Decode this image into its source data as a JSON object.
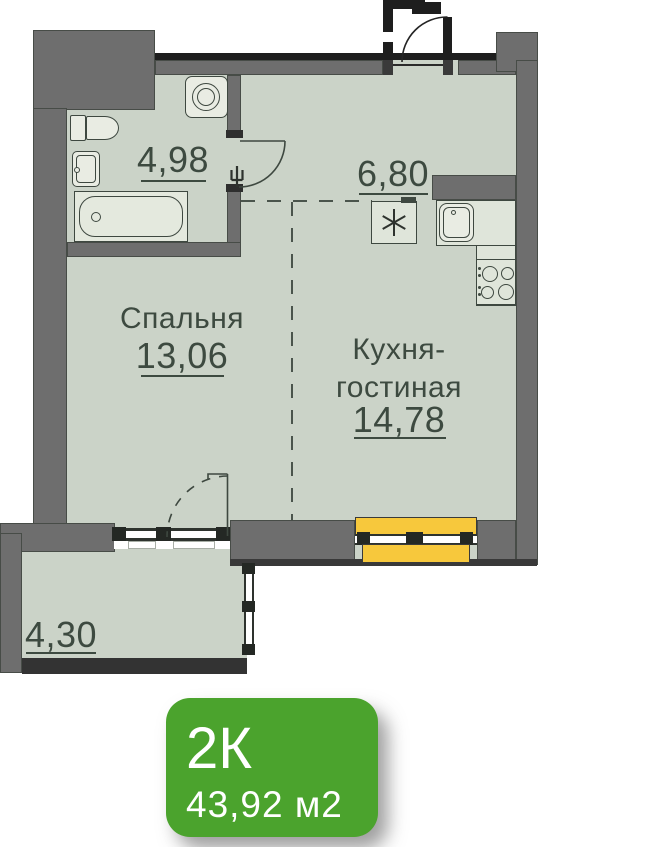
{
  "rooms": {
    "bathroom": {
      "area": "4,98"
    },
    "hallway": {
      "area": "6,80"
    },
    "bedroom": {
      "name": "Спальня",
      "area": "13,06"
    },
    "kitchen_living": {
      "name_line1": "Кухня-",
      "name_line2": "гостиная",
      "area": "14,78"
    },
    "balcony": {
      "area": "4,30"
    }
  },
  "badge": {
    "rooms": "2К",
    "area": "43,92 м2"
  },
  "colors": {
    "wall": "#6e6e6e",
    "floor": "#cbd3c8",
    "window_highlight": "#f7c83c",
    "badge_green": "#4ba32d",
    "text": "#3d4a40"
  },
  "fixtures": [
    "toilet-icon",
    "sink-icon",
    "bathtub-icon",
    "washing-machine-icon",
    "kitchen-sink-icon",
    "stove-icon",
    "vent-asterisk-icon",
    "door-swing-icon",
    "window-icon"
  ]
}
